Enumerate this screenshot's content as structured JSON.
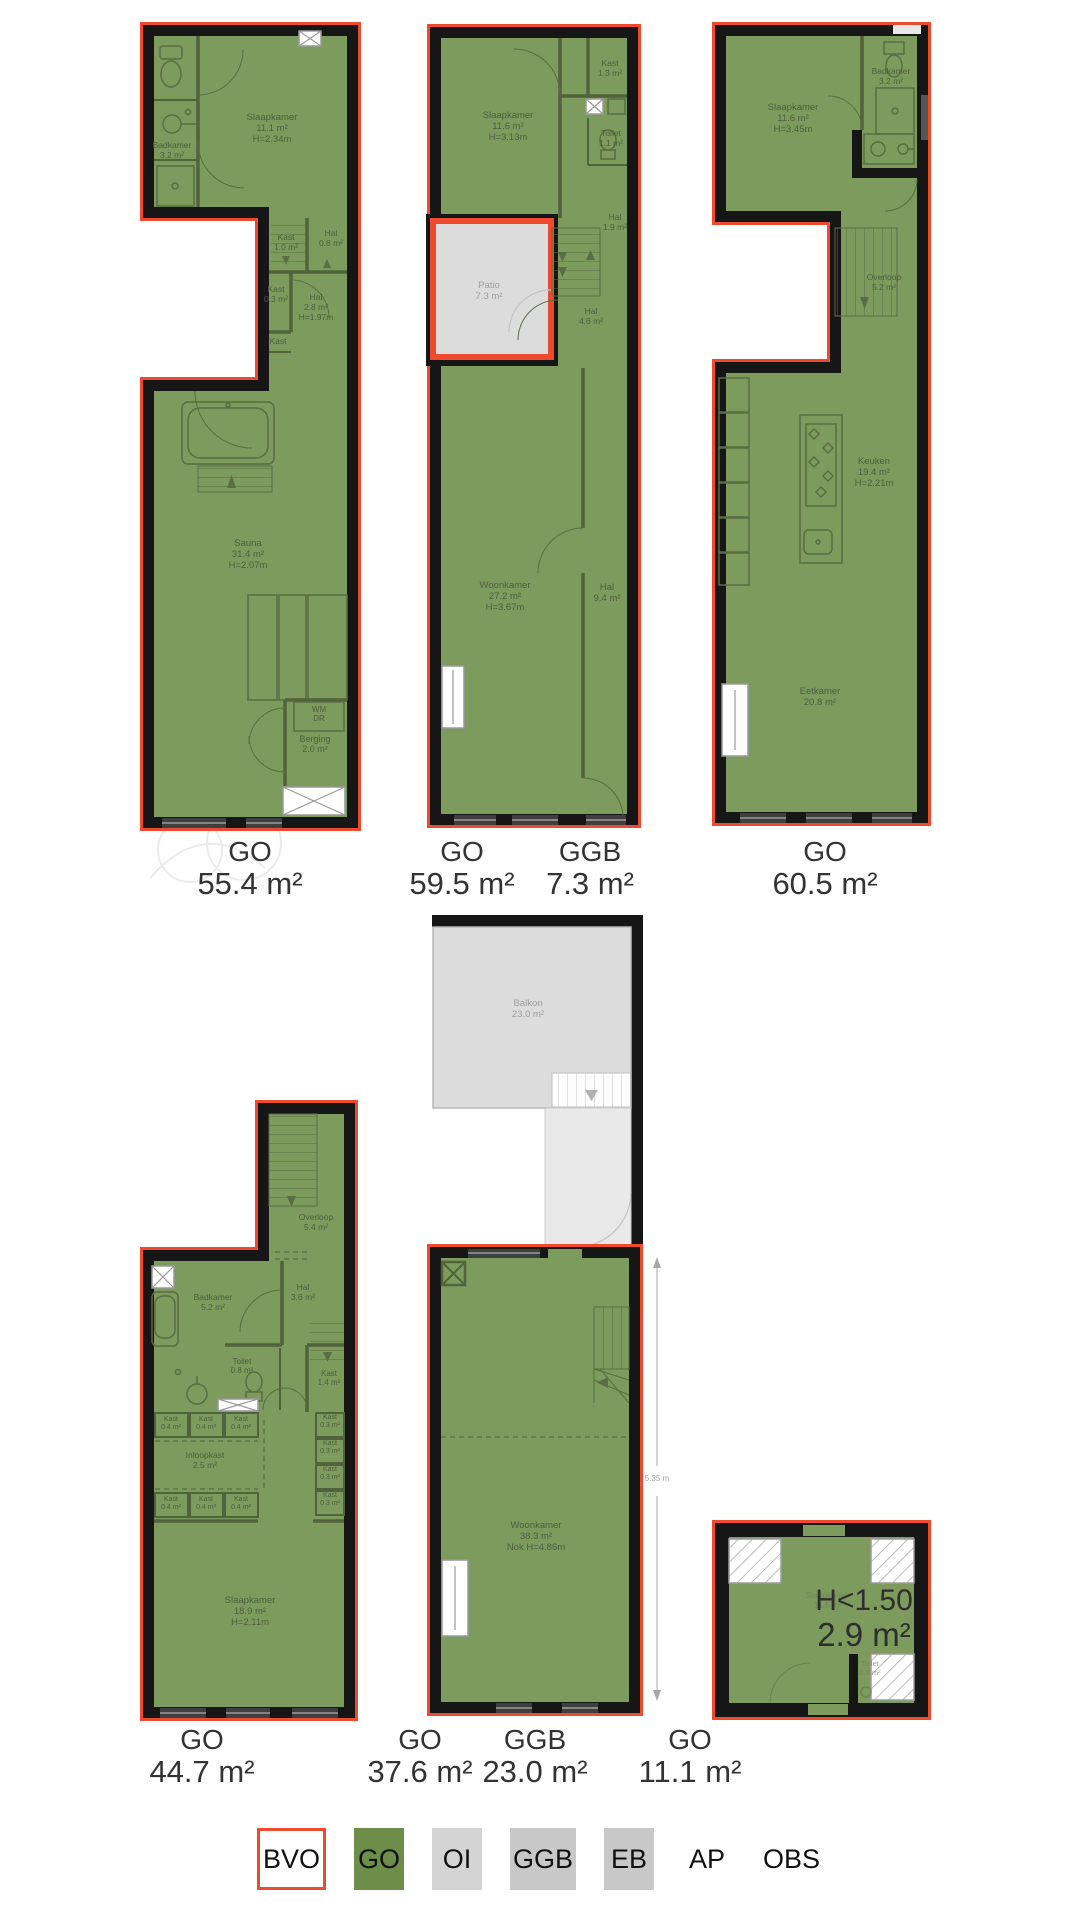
{
  "palette": {
    "go_green": "#7d9b5c",
    "bvo_red": "#ee4a2e",
    "ggb_grey": "#dcdcdc",
    "wall_black": "#161616",
    "legend_green": "#6d8d48",
    "legend_grey_oi": "#d4d4d4",
    "legend_grey": "#c8c8c8"
  },
  "plans": {
    "plan1": {
      "name": "unit-top-left",
      "labels": [
        {
          "x": 172,
          "y": 148,
          "lines": [
            "Badkamer",
            "3.2 m²"
          ],
          "size": 8.5,
          "lh": 10
        },
        {
          "x": 272,
          "y": 120,
          "lines": [
            "Slaapkamer",
            "11.1 m²",
            "H=2.34m"
          ]
        },
        {
          "x": 286,
          "y": 240,
          "lines": [
            "Kast",
            "1.0 m²"
          ],
          "size": 8.5,
          "lh": 10
        },
        {
          "x": 331,
          "y": 236,
          "lines": [
            "Hal",
            "0.8 m²"
          ],
          "size": 8.5,
          "lh": 10
        },
        {
          "x": 276,
          "y": 292,
          "lines": [
            "Kast",
            "0.3 m²"
          ],
          "size": 8.5,
          "lh": 10
        },
        {
          "x": 316,
          "y": 300,
          "lines": [
            "Hal",
            "2.8 m²",
            "H=1.97m"
          ],
          "size": 8.5,
          "lh": 10
        },
        {
          "x": 278,
          "y": 344,
          "lines": [
            "Kast"
          ],
          "size": 8.5,
          "lh": 10
        },
        {
          "x": 248,
          "y": 546,
          "lines": [
            "Sauna",
            "31.4 m²",
            "H=2.07m"
          ]
        },
        {
          "x": 319,
          "y": 712,
          "lines": [
            "WM",
            "DR"
          ],
          "size": 8,
          "lh": 9
        },
        {
          "x": 315,
          "y": 742,
          "lines": [
            "Berging",
            "2.0 m²"
          ],
          "size": 9,
          "lh": 10
        }
      ]
    },
    "plan2": {
      "name": "unit-top-middle",
      "labels": [
        {
          "x": 508,
          "y": 118,
          "lines": [
            "Slaapkamer",
            "11.6 m²",
            "H=3.13m"
          ]
        },
        {
          "x": 610,
          "y": 66,
          "lines": [
            "Kast",
            "1.3 m²"
          ],
          "size": 8.5,
          "lh": 10
        },
        {
          "x": 611,
          "y": 136,
          "lines": [
            "Toilet",
            "1.1 m²"
          ],
          "size": 8.5,
          "lh": 10
        },
        {
          "x": 615,
          "y": 220,
          "lines": [
            "Hal",
            "1.9 m²"
          ],
          "size": 8.5,
          "lh": 10
        },
        {
          "x": 489,
          "y": 288,
          "lines": [
            "Patio",
            "7.3 m²"
          ],
          "cls": "grey"
        },
        {
          "x": 591,
          "y": 314,
          "lines": [
            "Hal",
            "4.6 m²"
          ],
          "size": 8.5,
          "lh": 10
        },
        {
          "x": 505,
          "y": 588,
          "lines": [
            "Woonkamer",
            "27.2 m²",
            "H=3.67m"
          ]
        },
        {
          "x": 607,
          "y": 590,
          "lines": [
            "Hal",
            "9.4 m²"
          ]
        }
      ]
    },
    "plan3": {
      "name": "unit-top-right",
      "labels": [
        {
          "x": 793,
          "y": 110,
          "lines": [
            "Slaapkamer",
            "11.6 m²",
            "H=3.45m"
          ]
        },
        {
          "x": 891,
          "y": 74,
          "lines": [
            "Badkamer",
            "3.2 m²"
          ],
          "size": 8.5,
          "lh": 10
        },
        {
          "x": 884,
          "y": 280,
          "lines": [
            "Overloop",
            "5.2 m²"
          ],
          "size": 8.5,
          "lh": 10
        },
        {
          "x": 874,
          "y": 464,
          "lines": [
            "Keuken",
            "19.4 m²",
            "H=2.21m"
          ]
        },
        {
          "x": 820,
          "y": 694,
          "lines": [
            "Eetkamer",
            "20.8 m²"
          ]
        }
      ]
    },
    "balkon": {
      "name": "balcony-section",
      "labels": [
        {
          "x": 528,
          "y": 1006,
          "lines": [
            "Balkon",
            "23.0 m²"
          ],
          "cls": "grey"
        }
      ]
    },
    "plan4": {
      "name": "unit-bottom-left",
      "labels": [
        {
          "x": 316,
          "y": 1220,
          "lines": [
            "Overloop",
            "5.4 m²"
          ],
          "size": 8.5,
          "lh": 10
        },
        {
          "x": 213,
          "y": 1300,
          "lines": [
            "Badkamer",
            "5.2 m²"
          ],
          "size": 8.5,
          "lh": 10
        },
        {
          "x": 303,
          "y": 1290,
          "lines": [
            "Hal",
            "3.6 m²"
          ],
          "size": 8.5,
          "lh": 10
        },
        {
          "x": 242,
          "y": 1364,
          "lines": [
            "Toilet",
            "0.8 m²"
          ],
          "size": 8,
          "lh": 9
        },
        {
          "x": 329,
          "y": 1376,
          "lines": [
            "Kast",
            "1.4 m²"
          ],
          "size": 8,
          "lh": 9
        },
        {
          "x": 171,
          "y": 1421,
          "lines": [
            "Kast",
            "0.4 m²"
          ],
          "size": 7,
          "lh": 8
        },
        {
          "x": 206,
          "y": 1421,
          "lines": [
            "Kast",
            "0.4 m²"
          ],
          "size": 7,
          "lh": 8
        },
        {
          "x": 241,
          "y": 1421,
          "lines": [
            "Kast",
            "0.4 m²"
          ],
          "size": 7,
          "lh": 8
        },
        {
          "x": 205,
          "y": 1458,
          "lines": [
            "Inloopkast",
            "2.5 m²"
          ],
          "size": 8.5,
          "lh": 10
        },
        {
          "x": 171,
          "y": 1501,
          "lines": [
            "Kast",
            "0.4 m²"
          ],
          "size": 7,
          "lh": 8
        },
        {
          "x": 206,
          "y": 1501,
          "lines": [
            "Kast",
            "0.4 m²"
          ],
          "size": 7,
          "lh": 8
        },
        {
          "x": 241,
          "y": 1501,
          "lines": [
            "Kast",
            "0.4 m²"
          ],
          "size": 7,
          "lh": 8
        },
        {
          "x": 330,
          "y": 1419,
          "lines": [
            "Kast",
            "0.3 m²"
          ],
          "size": 7,
          "lh": 8
        },
        {
          "x": 330,
          "y": 1445,
          "lines": [
            "Kast",
            "0.3 m²"
          ],
          "size": 7,
          "lh": 8
        },
        {
          "x": 330,
          "y": 1471,
          "lines": [
            "Kast",
            "0.3 m²"
          ],
          "size": 7,
          "lh": 8
        },
        {
          "x": 330,
          "y": 1497,
          "lines": [
            "Kast",
            "0.3 m²"
          ],
          "size": 7,
          "lh": 8
        },
        {
          "x": 250,
          "y": 1603,
          "lines": [
            "Slaapkamer",
            "18.9 m²",
            "H=2.11m"
          ]
        }
      ]
    },
    "plan5": {
      "name": "unit-bottom-middle",
      "labels": [
        {
          "x": 536,
          "y": 1528,
          "lines": [
            "Woonkamer",
            "38.3 m²",
            "Nok H=4.86m"
          ]
        },
        {
          "x": 657,
          "y": 1481,
          "lines": [
            "5.35 m"
          ],
          "cls": "grey",
          "size": 8,
          "lh": 9
        }
      ]
    },
    "plan6": {
      "name": "unit-bottom-right",
      "labels": [
        {
          "x": 828,
          "y": 1598,
          "lines": [
            "Slaapkamer",
            "11.5 m²"
          ],
          "cls": "faded",
          "size": 8.5,
          "lh": 10
        },
        {
          "x": 870,
          "y": 1666,
          "lines": [
            "Toilet",
            "0.9 m²"
          ],
          "cls": "faded",
          "size": 7.5,
          "lh": 9
        },
        {
          "x": 864,
          "y": 1610,
          "lines": [
            "H<1.50"
          ],
          "cls": "big",
          "size": 30
        },
        {
          "x": 864,
          "y": 1646,
          "lines": [
            "2.9 m²"
          ],
          "cls": "big",
          "size": 33
        }
      ]
    }
  },
  "area_labels": [
    {
      "code": "GO",
      "value": "55.4 m²"
    },
    {
      "code": "GO",
      "value": "59.5 m²"
    },
    {
      "code": "GGB",
      "value": "7.3 m²"
    },
    {
      "code": "GO",
      "value": "60.5 m²"
    },
    {
      "code": "GO",
      "value": "44.7 m²"
    },
    {
      "code": "GO",
      "value": "37.6 m²"
    },
    {
      "code": "GGB",
      "value": "23.0 m²"
    },
    {
      "code": "GO",
      "value": "11.1 m²"
    }
  ],
  "legend": {
    "items": [
      {
        "label": "BVO",
        "box": "outline"
      },
      {
        "label": "GO",
        "box": "#6d8d48"
      },
      {
        "label": "OI",
        "box": "#d4d4d4"
      },
      {
        "label": "GGB",
        "box": "#c8c8c8"
      },
      {
        "label": "EB",
        "box": "#c8c8c8"
      },
      {
        "label": "AP",
        "box": "none"
      },
      {
        "label": "OBS",
        "box": "none"
      }
    ]
  }
}
